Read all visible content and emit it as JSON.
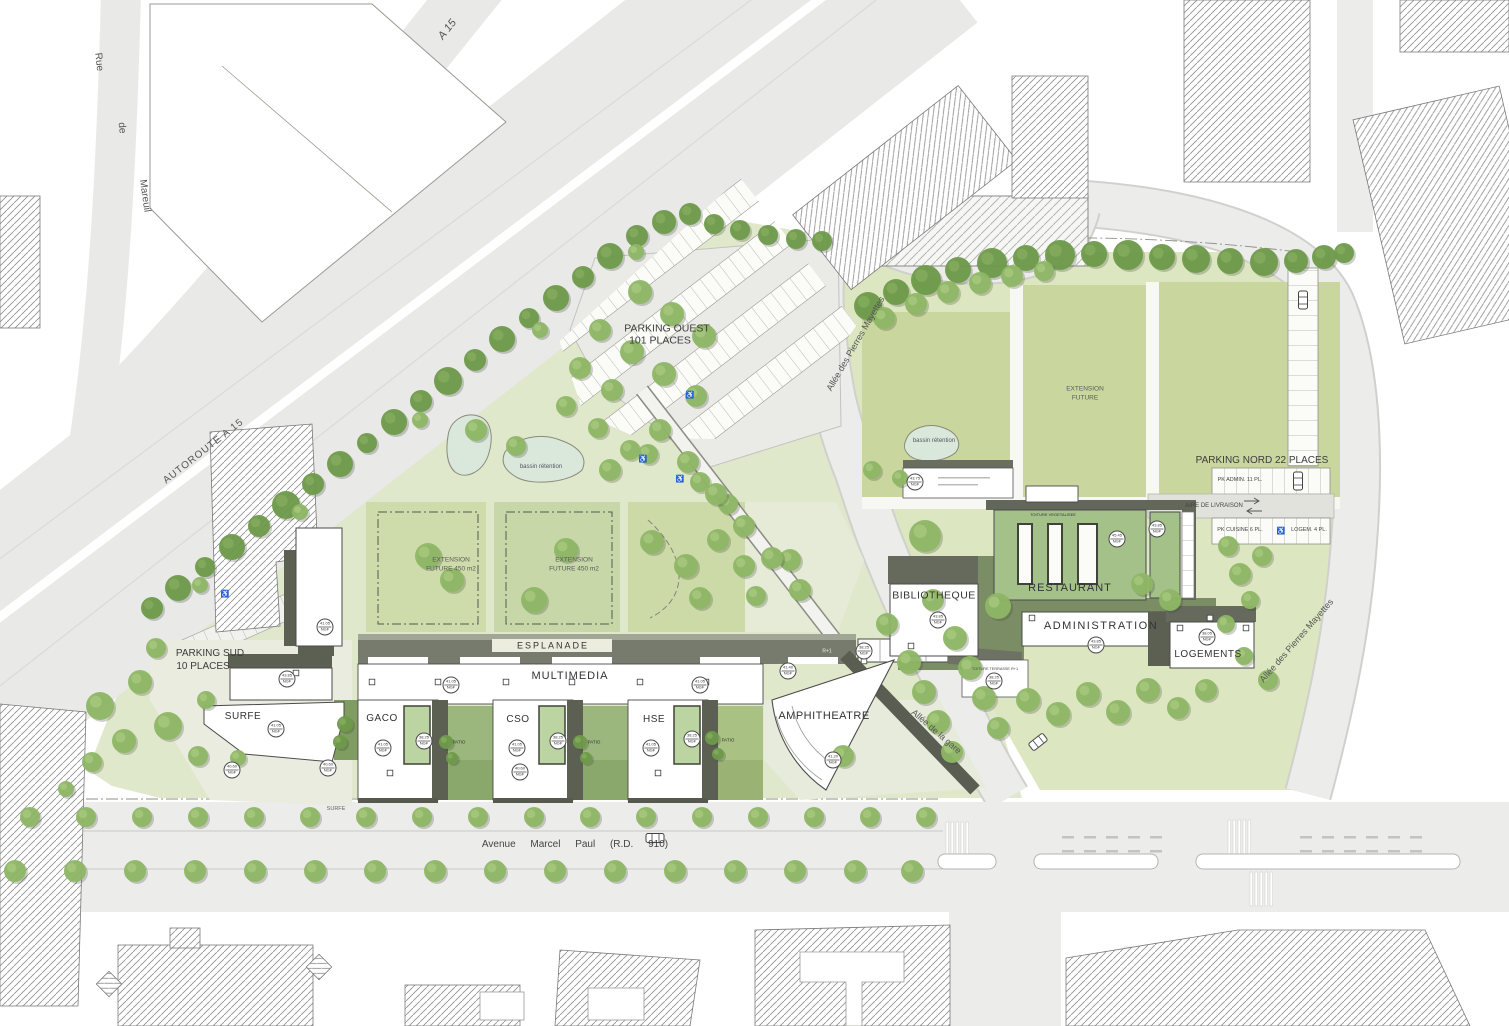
{
  "labels": {
    "a15": "A 15",
    "autoroute_a15": "AUTOROUTE A 15",
    "rue": "Rue",
    "de": "de",
    "mareuil": "Mareuil",
    "parking_ouest_l1": "PARKING OUEST",
    "parking_ouest_l2": "101 PLACES",
    "bassin_retention": "bassin rétention",
    "allee_pierres_mayettes": "Allée des Pierres Mayettes",
    "allee_de_la_gare": "Allée de la gare",
    "extension": "EXTENSION",
    "future_450": "FUTURE 450 m2",
    "future": "FUTURE",
    "parking_nord": "PARKING NORD 22 PLACES",
    "pk_admin": "PK ADMIN. 11 PL.",
    "aire_de_livraison": "AIRE DE LIVRAISON",
    "pk_cuisine": "PK CUISINE 6 PL.",
    "logem": "LOGEM. 4 PL.",
    "logements": "LOGEMENTS",
    "bibliotheque": "BIBLIOTHEQUE",
    "restaurant": "RESTAURANT",
    "administration": "ADMINISTRATION",
    "amphitheatre": "AMPHITHEATRE",
    "esplanade": "ESPLANADE",
    "multimedia": "MULTIMEDIA",
    "gaco": "GACO",
    "cso": "CSO",
    "hse": "HSE",
    "surfe": "SURFE",
    "parking_sud_l1": "PARKING SUD",
    "parking_sud_l2": "10 PLACES",
    "avenue_marcel_paul": "Avenue Marcel Paul (R.D. 910)",
    "patio": "PATIO",
    "r_plus_1": "R+1",
    "toiture_terrasse": "TOITURE TERRASSE R+1",
    "toiture_vegetalisee": "TOITURE VEGETALISEE"
  },
  "icons": {
    "wheelchair": "♿"
  },
  "elevation": {
    "unit": "NGF",
    "markers": [
      {
        "x": 325,
        "y": 627,
        "v": "41.05"
      },
      {
        "x": 287,
        "y": 679,
        "v": "43.85"
      },
      {
        "x": 276,
        "y": 729,
        "v": "41.05"
      },
      {
        "x": 451,
        "y": 685,
        "v": "41.05"
      },
      {
        "x": 700,
        "y": 685,
        "v": "41.05"
      },
      {
        "x": 383,
        "y": 748,
        "v": "41.05"
      },
      {
        "x": 517,
        "y": 748,
        "v": "41.05"
      },
      {
        "x": 651,
        "y": 748,
        "v": "41.05"
      },
      {
        "x": 424,
        "y": 741,
        "v": "38.25"
      },
      {
        "x": 558,
        "y": 741,
        "v": "38.25"
      },
      {
        "x": 692,
        "y": 739,
        "v": "38.25"
      },
      {
        "x": 938,
        "y": 620,
        "v": "43.85"
      },
      {
        "x": 1096,
        "y": 645,
        "v": "43.85"
      },
      {
        "x": 1117,
        "y": 539,
        "v": "45.45"
      },
      {
        "x": 1157,
        "y": 529,
        "v": "43.85"
      },
      {
        "x": 1207,
        "y": 637,
        "v": "38.05"
      },
      {
        "x": 788,
        "y": 671,
        "v": "41.40"
      },
      {
        "x": 864,
        "y": 651,
        "v": "38.25"
      },
      {
        "x": 833,
        "y": 760,
        "v": "41.20"
      },
      {
        "x": 915,
        "y": 482,
        "v": "43.75"
      },
      {
        "x": 994,
        "y": 681,
        "v": "38.25"
      },
      {
        "x": 232,
        "y": 770,
        "v": "40.60"
      },
      {
        "x": 328,
        "y": 768,
        "v": "40.60"
      },
      {
        "x": 520,
        "y": 772,
        "v": "40.60"
      }
    ]
  },
  "colors": {
    "site_green": "#e0e8cb",
    "meadow": "#c9d79e",
    "lawn": "#cddcaa",
    "roof_dark": "#5c6053",
    "roof_green": "#a3c189",
    "pond": "#d9e8da",
    "road": "#ececea",
    "tree": "#8eb765",
    "tree_dark": "#6e9a4a"
  }
}
